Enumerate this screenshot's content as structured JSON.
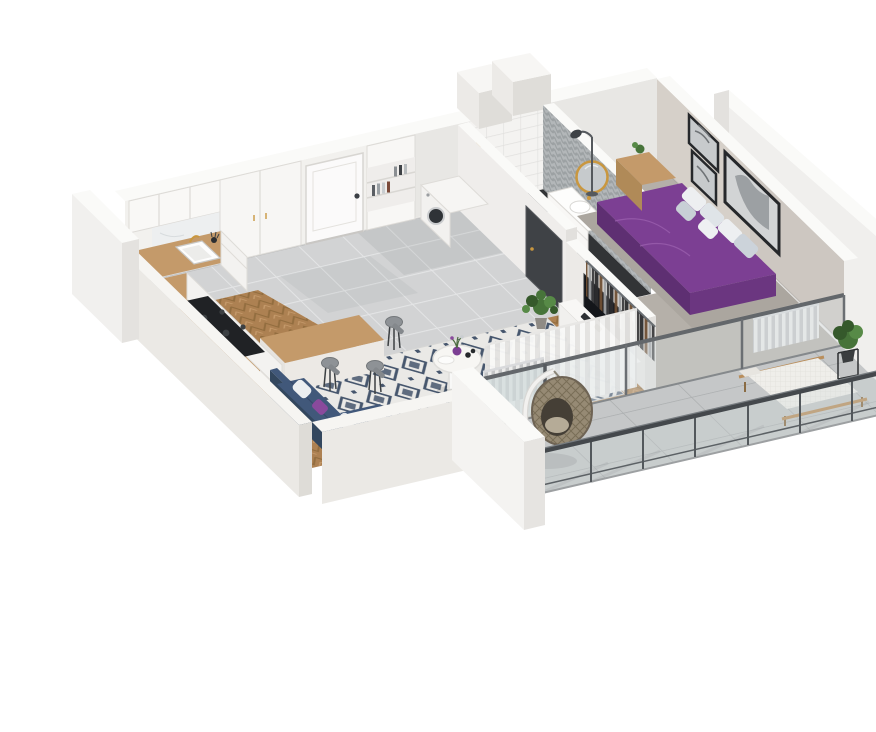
{
  "meta": {
    "title": "3D isometric cutaway floor plan render of a one-bedroom apartment with balcony",
    "type": "architectural visualization",
    "background": "#ffffff"
  },
  "palette": {
    "wallTop": "#fafaf8",
    "wallFace": "#f2f1ee",
    "wallBand": "#f6f5f2",
    "wallExt": "#ebe9e5",
    "wallExt2": "#dedcd7",
    "greige": "#d6d0c9",
    "tile": "#d2d3d4",
    "tileLine": "#e4e5e6",
    "wood": "#ad8152",
    "woodDark": "#926d3f",
    "woodLight": "#c59a6b",
    "counter": "#c49a6a",
    "concrete": "#c5c7c8",
    "concreteLine": "#acafb0",
    "rugBg": "#eae9e6",
    "rugMotif": "#46566d",
    "purple": "#7c3f93",
    "purpleDark": "#5e2f72",
    "purpleSide": "#6b3680",
    "sofa": "#41587a",
    "sofaDark": "#33475e",
    "pillowPurple": "#8a4a9c",
    "tv": "#14161a",
    "rail": "#44484c",
    "railMid": "#5c6165",
    "glass": "#d7e0e2",
    "plant": "#47743a",
    "plantDark": "#35592b",
    "plantLight": "#578a47",
    "gold": "#c9973f",
    "chevA": "#b3b7b9",
    "chevB": "#9ca1a3",
    "marble": "#edeff0",
    "darkFloor": "#323436",
    "doorDark": "#3f4246",
    "rattan": "#968a74",
    "rattanLine": "#796e57",
    "radA": "#ececeb",
    "radB": "#c5c6c7",
    "curA": "#f8f8f7",
    "curB": "#e4e3e1",
    "carpet": "#aba69f",
    "steel": "#8e9296",
    "white": "#ffffff"
  },
  "rooms": {
    "kitchen": {
      "label": "Kitchen",
      "items": [
        "white panel cabinets",
        "wooden countertop",
        "sink with gold faucet",
        "black cooktop",
        "marble backsplash",
        "breakfast bar",
        "bar stools"
      ]
    },
    "hallway": {
      "label": "Entrance hall",
      "items": [
        "white entrance door",
        "tall bookshelf cabinet",
        "washing machine",
        "grey tile floor"
      ]
    },
    "bathroom": {
      "label": "Bathroom",
      "items": [
        "chevron tiled wall",
        "round gold mirror",
        "white vanity with sink",
        "walk-in shower",
        "dark tile floor"
      ]
    },
    "living_room": {
      "label": "Living room",
      "items": [
        "navy sofa with cushions",
        "diamond pattern rug",
        "round pleated side table",
        "purple vase",
        "media wall with TV",
        "white sideboard",
        "monstera plant",
        "white curtains",
        "radiator",
        "herringbone oak floor"
      ]
    },
    "bedroom": {
      "label": "Bedroom",
      "items": [
        "double bed with purple bedding",
        "grey and white pillows",
        "gallery wall frames",
        "wall mounted TV",
        "wooden nightstand",
        "floor lamp",
        "open clothes rack",
        "radiator"
      ]
    },
    "balcony": {
      "label": "Balcony",
      "items": [
        "steel and glass railing",
        "concrete tile floor",
        "hanging rattan egg chair",
        "wooden sun lounger",
        "plant stand"
      ]
    },
    "exterior": {
      "label": "Building shell",
      "items": [
        "white cutaway walls",
        "ventilation shafts",
        "neighbouring wall"
      ]
    }
  }
}
